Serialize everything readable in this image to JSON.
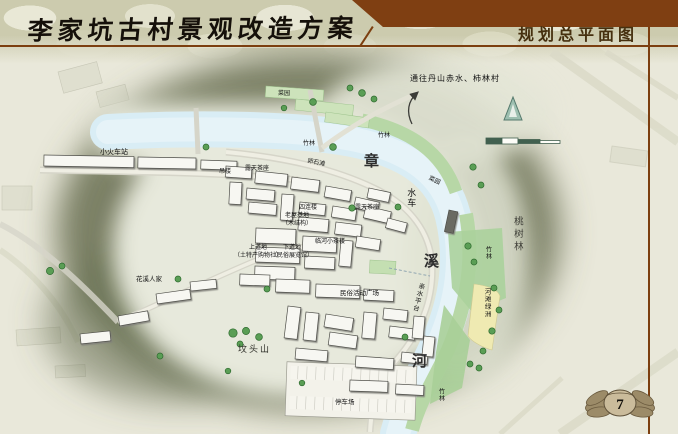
{
  "header": {
    "title": "李家坑古村景观改造方案",
    "section": "规划总平面图"
  },
  "footer": {
    "page_number": "7"
  },
  "map": {
    "labels": [
      {
        "text": "通往丹山赤水、柿林村"
      },
      {
        "text": "小火车站"
      },
      {
        "text": "菜园"
      },
      {
        "text": "竹林"
      },
      {
        "text": "竹林"
      },
      {
        "text": "吊楼"
      },
      {
        "text": "露天茶座"
      },
      {
        "text": "卵石滩"
      },
      {
        "text": "露天茶座"
      },
      {
        "text": "菜园"
      },
      {
        "text": "水车"
      },
      {
        "text": "四连楼"
      },
      {
        "text": "老屋基地\n（木结构）"
      },
      {
        "text": "临河小茶楼"
      },
      {
        "text": "上道地\n（土特产购物社）"
      },
      {
        "text": "下道地\n（民俗展览馆）"
      },
      {
        "text": "花溪人家"
      },
      {
        "text": "民俗活动广场"
      },
      {
        "text": "亲水平台"
      },
      {
        "text": "河滩绿洲"
      },
      {
        "text": "竹林"
      },
      {
        "text": "桃树林"
      },
      {
        "text": "坟头山"
      },
      {
        "text": "停车场"
      },
      {
        "text": "竹林"
      }
    ],
    "river_chars": [
      {
        "text": "章"
      },
      {
        "text": "溪"
      },
      {
        "text": "河"
      }
    ],
    "icons": {
      "north_arrow": "north-arrow-icon",
      "scale_bar": "scale-bar",
      "route_arrow": "route-arrow-icon",
      "page_emblem": "wings-emblem-icon"
    }
  },
  "colors": {
    "accent_brown": "#7c3f10",
    "panel_brown": "#7f3f12",
    "paper": "#e9e8da",
    "river_blue": "#d9edf5",
    "park_green": "#b7d7a6",
    "sand_yellow": "#efeab2",
    "halo_olive": "#6e7457"
  }
}
